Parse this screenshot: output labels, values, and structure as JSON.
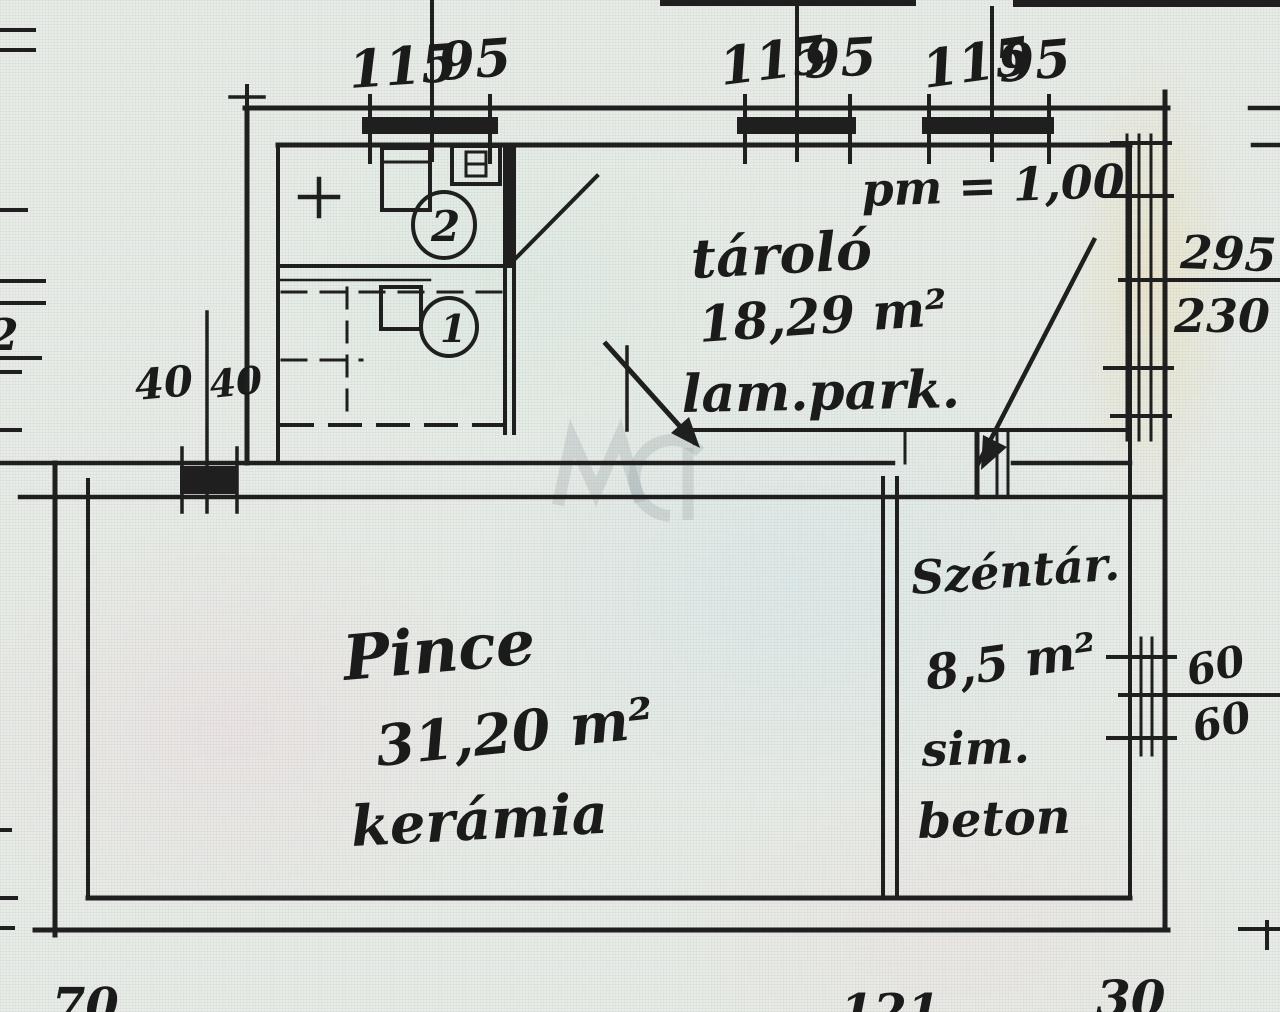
{
  "plan": {
    "annotation_pm": "pm = 1,00",
    "rooms": {
      "tarolo": {
        "name": "tároló",
        "area": "18,29 m²",
        "floor": "lam.park."
      },
      "pince": {
        "name": "Pince",
        "area": "31,20 m²",
        "floor": "kerámia"
      },
      "szentar": {
        "name": "Széntár.",
        "area": "8,5 m²",
        "floor_a": "sim.",
        "floor_b": "beton"
      }
    },
    "stairs": {
      "flight_upper": "2",
      "flight_lower": "1"
    },
    "dims": {
      "top_w1_a": "115",
      "top_w1_b": "95",
      "top_w2_a": "115",
      "top_w2_b": "95",
      "top_w3_a": "115",
      "top_w3_b": "95",
      "left_w_a": "40",
      "left_w_b": "40",
      "right_w_upper_a": "295",
      "right_w_upper_b": "230",
      "right_w_lower_a": "60",
      "right_w_lower_b": "60",
      "bottom_a": "70",
      "bottom_b": "121",
      "bottom_c": "30",
      "edge_partial": "2"
    },
    "colors": {
      "ink": "#1f1f1f",
      "paper": "#e8ece7",
      "watermark": "#8f99a0"
    }
  }
}
